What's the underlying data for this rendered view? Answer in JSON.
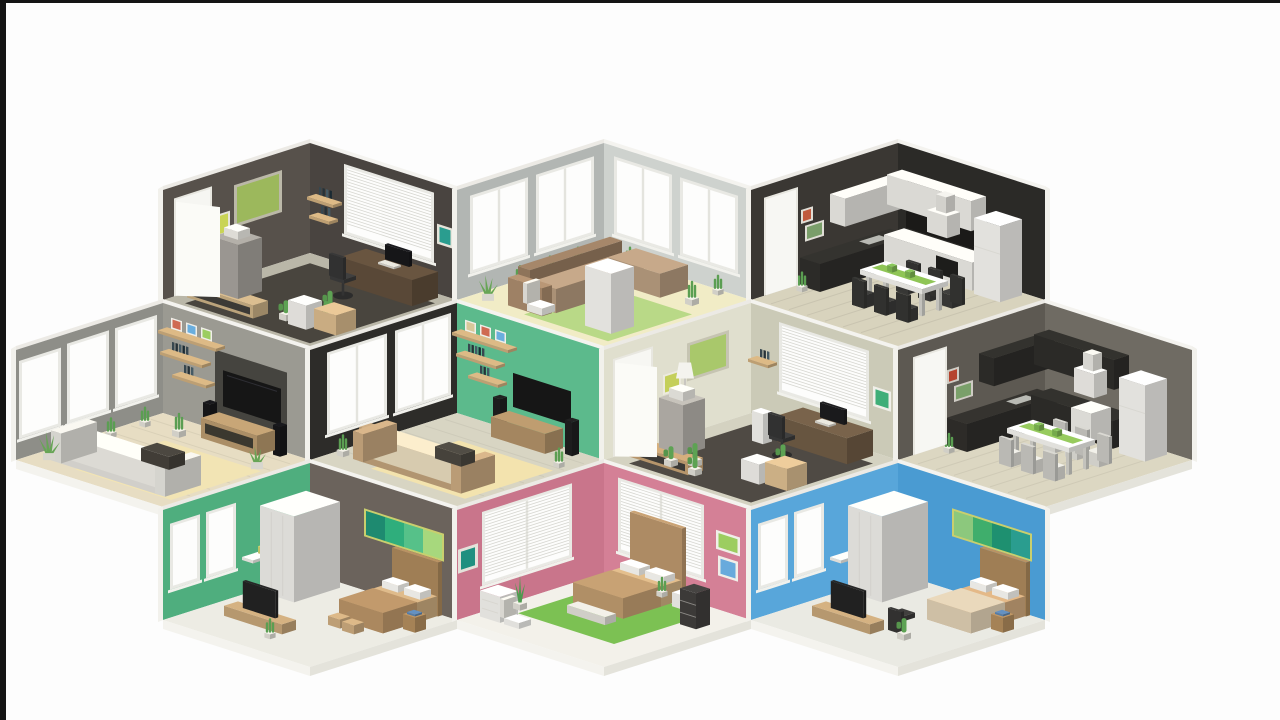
{
  "scene": {
    "description": "Low-poly isometric honeycomb arrangement of ten furnished room dioramas (offices, living rooms, kitchens, bedrooms) on a white background, framed by thin black letterbox bars on the left and top edges",
    "background": "#fdfdfd",
    "letterbox": {
      "left_bar_width": 6,
      "top_bar_height": 3,
      "color": "#141414"
    },
    "palette": {
      "wall_cap_left": "#eceae5",
      "wall_cap_right": "#f4f3ef",
      "outer_edge": "#f2f1ec",
      "slab_left": "#f4f3ee",
      "slab_right": "#e4e3db",
      "wood": "#c9a97a",
      "wood_dark": "#8a6f4e",
      "white": "#efeeea",
      "tv_black": "#161616",
      "cactus": "#5da253",
      "plant": "#67a556",
      "frame_red": "#cf6a52",
      "frame_blue": "#6aaede",
      "frame_green": "#9ccd60",
      "frame_teal": "#2a9d8f"
    },
    "rooms": [
      {
        "id": "office-dark",
        "label": "home office with dark walls",
        "cx": 310,
        "ty": 143,
        "colors": {
          "wallLeft": "#57514b",
          "wallRight": "#494440",
          "floor": "#bab7a8",
          "rug": "#49453e",
          "board": "#9cb85c",
          "poster": "#c9d455",
          "accentFrame": "#2a9d8f"
        },
        "furniture": [
          "open-door",
          "pin-board",
          "poster",
          "blinds-window",
          "teal-frame",
          "wall-shelves",
          "office-cabinet",
          "printer",
          "desk",
          "monitor",
          "keyboard",
          "office-chair",
          "cactus-plants",
          "cardboard-box",
          "drawer-unit",
          "media-bench"
        ]
      },
      {
        "id": "living-bright",
        "label": "bright living room with panorama windows",
        "cx": 604,
        "ty": 143,
        "colors": {
          "wallLeft": "#b2b6b3",
          "wallRight": "#ced2ce",
          "floor": "#f1ecc6",
          "rug": "#b9d987",
          "sofa": "#a8896b",
          "sofaSeat": "#b59a7d"
        },
        "furniture": [
          "panorama-windows",
          "sill-plants",
          "green-rug",
          "corner-sofa",
          "chaise-lounge",
          "side-chair",
          "white-cabinet",
          "agave-plant"
        ]
      },
      {
        "id": "kitchen-dark",
        "label": "kitchen with near-black walls and white cabinets",
        "cx": 898,
        "ty": 143,
        "colors": {
          "wallLeft": "#3a3733",
          "wallRight": "#2b2a27",
          "floor": "#d8d3bd",
          "cabinet": "#e8e7e2",
          "counter": "#2f2e2b",
          "runner": "#8fc556",
          "chair": "#3a3a38",
          "frameRed": "#c05a3e",
          "frameGreen": "#7a9e6a"
        },
        "furniture": [
          "door",
          "red-frame",
          "green-frame",
          "upper-cabinets",
          "range-hood",
          "counter-with-sink",
          "lower-cabinets",
          "oven",
          "fridge",
          "dining-table",
          "green-table-runner",
          "dining-chairs"
        ]
      },
      {
        "id": "living-gray",
        "label": "gray living room with white sofa and TV wall",
        "cx": 163,
        "ty": 303,
        "colors": {
          "wallLeft": "#8e8e88",
          "wallRight": "#9b9a92",
          "nook": "#45443f",
          "floor": "#e7ddc3",
          "rug": "#f2e4b4",
          "sofa": "#eae8e2"
        },
        "furniture": [
          "panorama-windows",
          "tv-nook",
          "tv",
          "wood-shelves",
          "picture-frames",
          "books",
          "tv-stand",
          "floor-speakers",
          "white-sofa",
          "coffee-table",
          "pale-rug",
          "agave-plants"
        ]
      },
      {
        "id": "living-green",
        "label": "living room with green accent wall",
        "cx": 457,
        "ty": 303,
        "colors": {
          "wallLeft": "#2d2c29",
          "wallRight": "#5cba8c",
          "floor": "#d8d5c3",
          "rug": "#f3e3ae",
          "sofa": "#c6a67e",
          "sofaSeat": "#e5d8ba"
        },
        "furniture": [
          "panorama-windows",
          "tv",
          "wood-shelves",
          "picture-frames",
          "books",
          "tv-stand",
          "floor-speakers",
          "sofa",
          "pale-rug",
          "snake-plant"
        ]
      },
      {
        "id": "office-light",
        "label": "home office with light sage walls",
        "cx": 751,
        "ty": 303,
        "colors": {
          "wallLeft": "#e0dfce",
          "wallRight": "#cbcab7",
          "floor": "#d4d2c1",
          "rug": "#4f4a44",
          "board": "#a9c86b",
          "poster": "#c4cf5a",
          "accentFrame": "#3fae78"
        },
        "furniture": [
          "open-door",
          "floor-lamp",
          "pin-board",
          "poster",
          "blinds-window",
          "green-frame",
          "wall-shelves",
          "office-cabinet",
          "printer",
          "desk",
          "monitor",
          "office-chair",
          "white-speaker",
          "cactus-plants",
          "cardboard-box",
          "drawer-unit",
          "media-bench"
        ]
      },
      {
        "id": "kitchen-gray",
        "label": "kitchen with gray walls and black cabinets",
        "cx": 1045,
        "ty": 303,
        "colors": {
          "wallLeft": "#5d5952",
          "wallRight": "#6f6b63",
          "floor": "#dcd7c2",
          "cabinet": "#2e2d2a",
          "counter": "#302e2b",
          "runner": "#97cb5e",
          "chair": "#dcdbd5",
          "frameRed": "#b5432e",
          "frameGreen": "#7aa06a"
        },
        "furniture": [
          "door",
          "red-frame",
          "green-frame",
          "upper-cabinets",
          "range-hood",
          "counter-with-sink",
          "lower-cabinets",
          "oven",
          "fridge",
          "dining-table",
          "green-table-runner",
          "dining-chairs"
        ]
      },
      {
        "id": "bedroom-green",
        "label": "bedroom with green wall and gradient artwork",
        "cx": 310,
        "ty": 463,
        "colors": {
          "wallLeft": "#4fae7e",
          "wallRight": "#6b635c",
          "floor": "#edece4",
          "blanket": "#c29a6c",
          "art": [
            "#1e8a70",
            "#2fae7c",
            "#56c189",
            "#a7d87d"
          ],
          "artFrame": "#c9cf6e"
        },
        "furniture": [
          "windows",
          "wall-shelf-desk",
          "desk-chair",
          "wardrobe",
          "gradient-artwork",
          "double-bed",
          "pillows",
          "foot-stools",
          "nightstand",
          "tv-bench",
          "tv",
          "plant"
        ]
      },
      {
        "id": "bedroom-pink",
        "label": "pink bedroom with green rug",
        "cx": 604,
        "ty": 463,
        "colors": {
          "wallLeft": "#c9758b",
          "wallRight": "#d48096",
          "floor": "#f3f1ea",
          "rug": "#7cc153",
          "blanket": "#c8a274",
          "frameTeal": "#1f9080",
          "frameGreen": "#9ccd60",
          "frameBlue": "#68aadc"
        },
        "furniture": [
          "blinds-windows",
          "teal-frame",
          "green-frame",
          "blue-frame",
          "double-bed",
          "pillows",
          "green-rug",
          "side-chair",
          "dresser",
          "shelf-unit",
          "nightstand",
          "foot-bench",
          "snake-plant"
        ]
      },
      {
        "id": "bedroom-blue",
        "label": "blue bedroom with gradient artwork",
        "cx": 898,
        "ty": 463,
        "colors": {
          "wallLeft": "#58a6da",
          "wallRight": "#4a9bd2",
          "floor": "#eaeae3",
          "blanket": "#ead9bc",
          "art": [
            "#8cc87d",
            "#3fae6c",
            "#1e9070",
            "#2a9d8f"
          ],
          "artFrame": "#c9cf6e"
        },
        "furniture": [
          "windows",
          "wall-shelf-desk",
          "wardrobe",
          "gradient-artwork",
          "double-bed",
          "pillows",
          "desk-chair",
          "nightstand",
          "tv-bench",
          "tv",
          "cactus"
        ]
      }
    ]
  }
}
